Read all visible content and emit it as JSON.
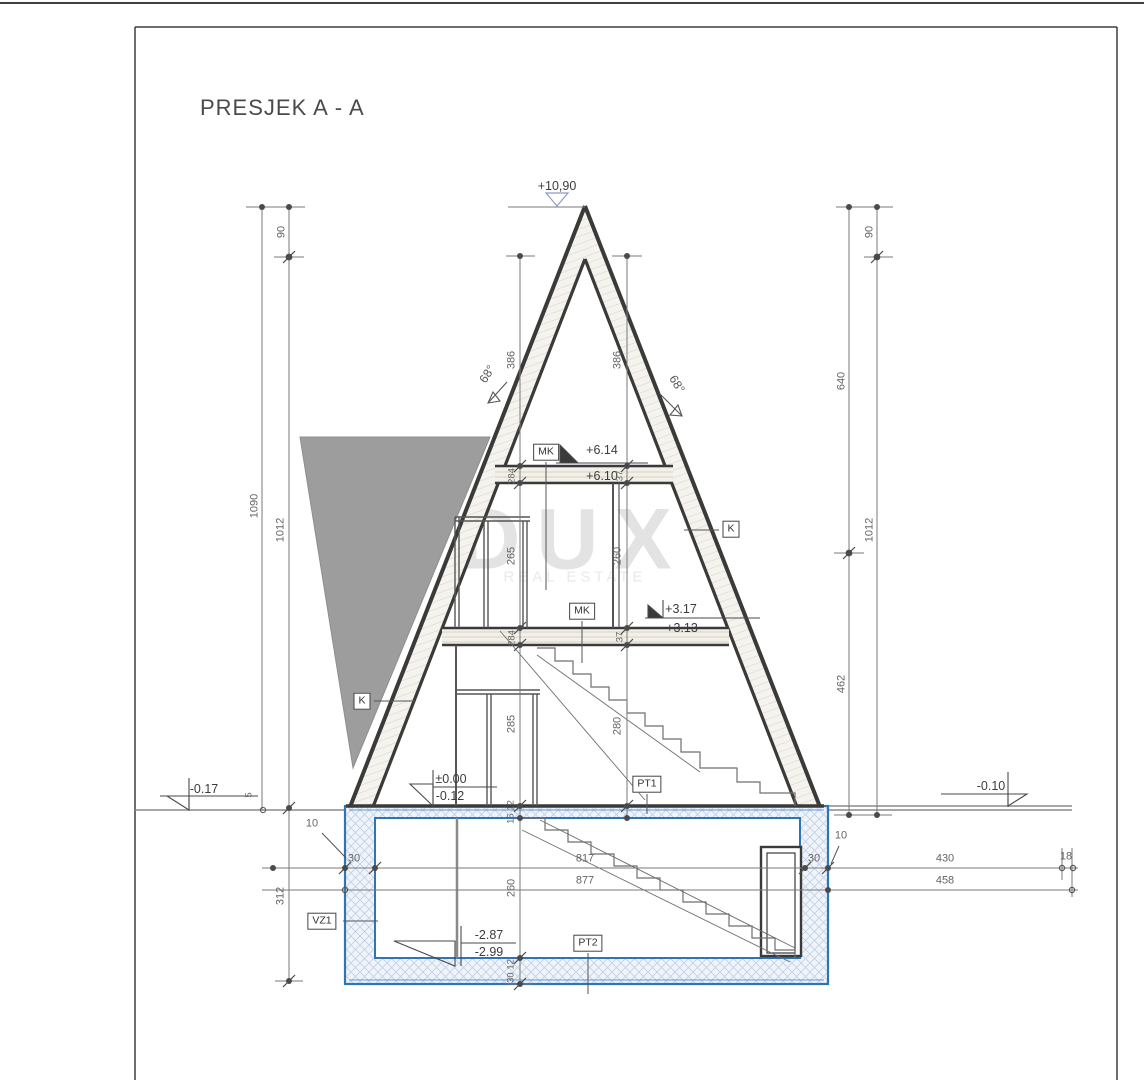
{
  "title": "PRESJEK A - A",
  "watermark": {
    "brand": "DUX",
    "tagline": "REAL ESTATE"
  },
  "elevations": {
    "apex": "+10,90",
    "upper_top": "+6.14",
    "upper_bottom": "+6.10",
    "mid_top": "+3.17",
    "mid_bottom": "+3.13",
    "ground_top": "±0.00",
    "ground_bottom": "-0.12",
    "terrain_left": "-0.17",
    "terrain_right": "-0.10",
    "basement_top": "-2.87",
    "basement_bottom": "-2.99"
  },
  "tags": {
    "mk": "MK",
    "k": "K",
    "pt1": "PT1",
    "pt2": "PT2",
    "vz1": "VZ1"
  },
  "angles": {
    "left": "68°",
    "right": "68°"
  },
  "dims": {
    "col_outer_left": {
      "total": "1090",
      "top": "90",
      "main": "1012",
      "basement": "312",
      "offset": "5"
    },
    "col_outer_right": {
      "top": "90",
      "upper": "640",
      "main": "1012",
      "lower": "462"
    },
    "col_inner_left": {
      "seg1": "386",
      "seg2": "284",
      "seg3": "265",
      "seg4": "284",
      "seg5": "285",
      "seg6": "15 12",
      "seg7": "260",
      "seg8": "30 12"
    },
    "col_inner_right": {
      "seg1": "386",
      "seg2": "37",
      "seg3": "260",
      "seg4": "37",
      "seg5": "280"
    },
    "row_basement_top": {
      "wall_left": "30",
      "inner": "817",
      "wall_right": "30",
      "right": "430",
      "edge": "18"
    },
    "row_basement_bottom": {
      "overall": "877",
      "right": "458"
    },
    "insulation_left": "10",
    "insulation_right": "10"
  },
  "colors": {
    "structure": "#3a3a3a",
    "dimension": "#6a6a6a",
    "waterproofing_blue": "#2f74b5",
    "terrain_gray": "#9d9d9d"
  }
}
